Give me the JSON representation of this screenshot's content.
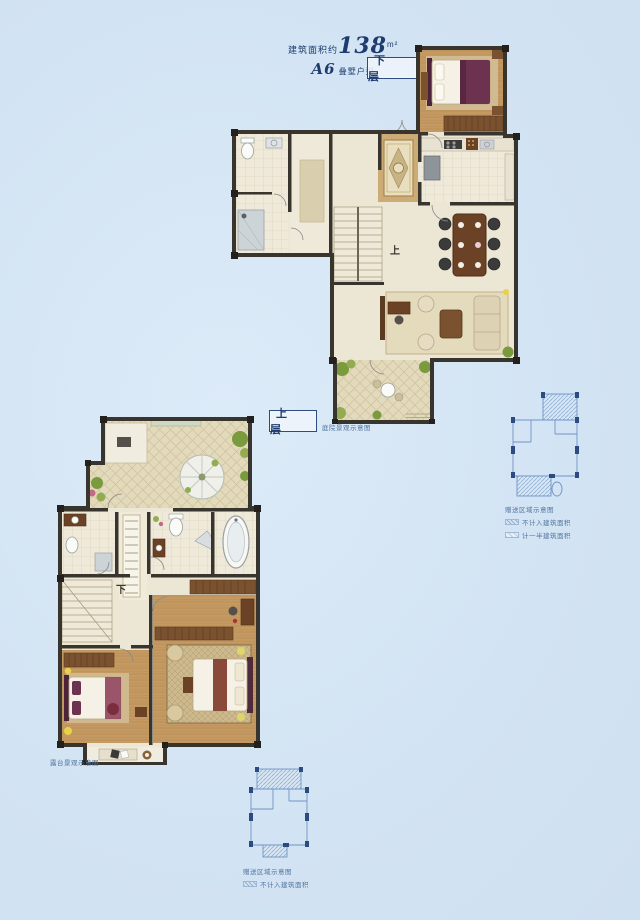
{
  "header": {
    "area_prefix": "建筑面积约",
    "area_value": "138",
    "area_unit": "m²",
    "unit_code": "A6",
    "unit_type": "叠墅户型"
  },
  "floors": {
    "lower": {
      "label": "下 层",
      "stair_char": "上",
      "caption": "庭院景观示意图"
    },
    "upper": {
      "label": "上 层",
      "stair_char": "下",
      "caption": "露台景观示意图"
    }
  },
  "legend_right": {
    "title": "赠送区域示意图",
    "items": [
      {
        "swatch": "dense-hatch",
        "label": "不计入建筑面积"
      },
      {
        "swatch": "light-hatch",
        "label": "计一半建筑面积"
      }
    ]
  },
  "legend_bottom": {
    "title": "赠送区域示意图",
    "items": [
      {
        "swatch": "dense-hatch",
        "label": "不计入建筑面积"
      }
    ]
  },
  "colors": {
    "background": "#d5e5f4",
    "text_navy": "#1e3c6e",
    "caption_blue": "#51749f",
    "wall_dark": "#38342e",
    "floor_tile": "#ece6d4",
    "terrace_tile": "#e3d9bb",
    "wood_floor": "#c49a62",
    "furniture_brown": "#6b4226",
    "bedding_maroon": "#6d3250",
    "plant_green": "#7a9a3e",
    "keyplan_line": "#6f94c4",
    "keyplan_wall": "#2c4c80"
  }
}
